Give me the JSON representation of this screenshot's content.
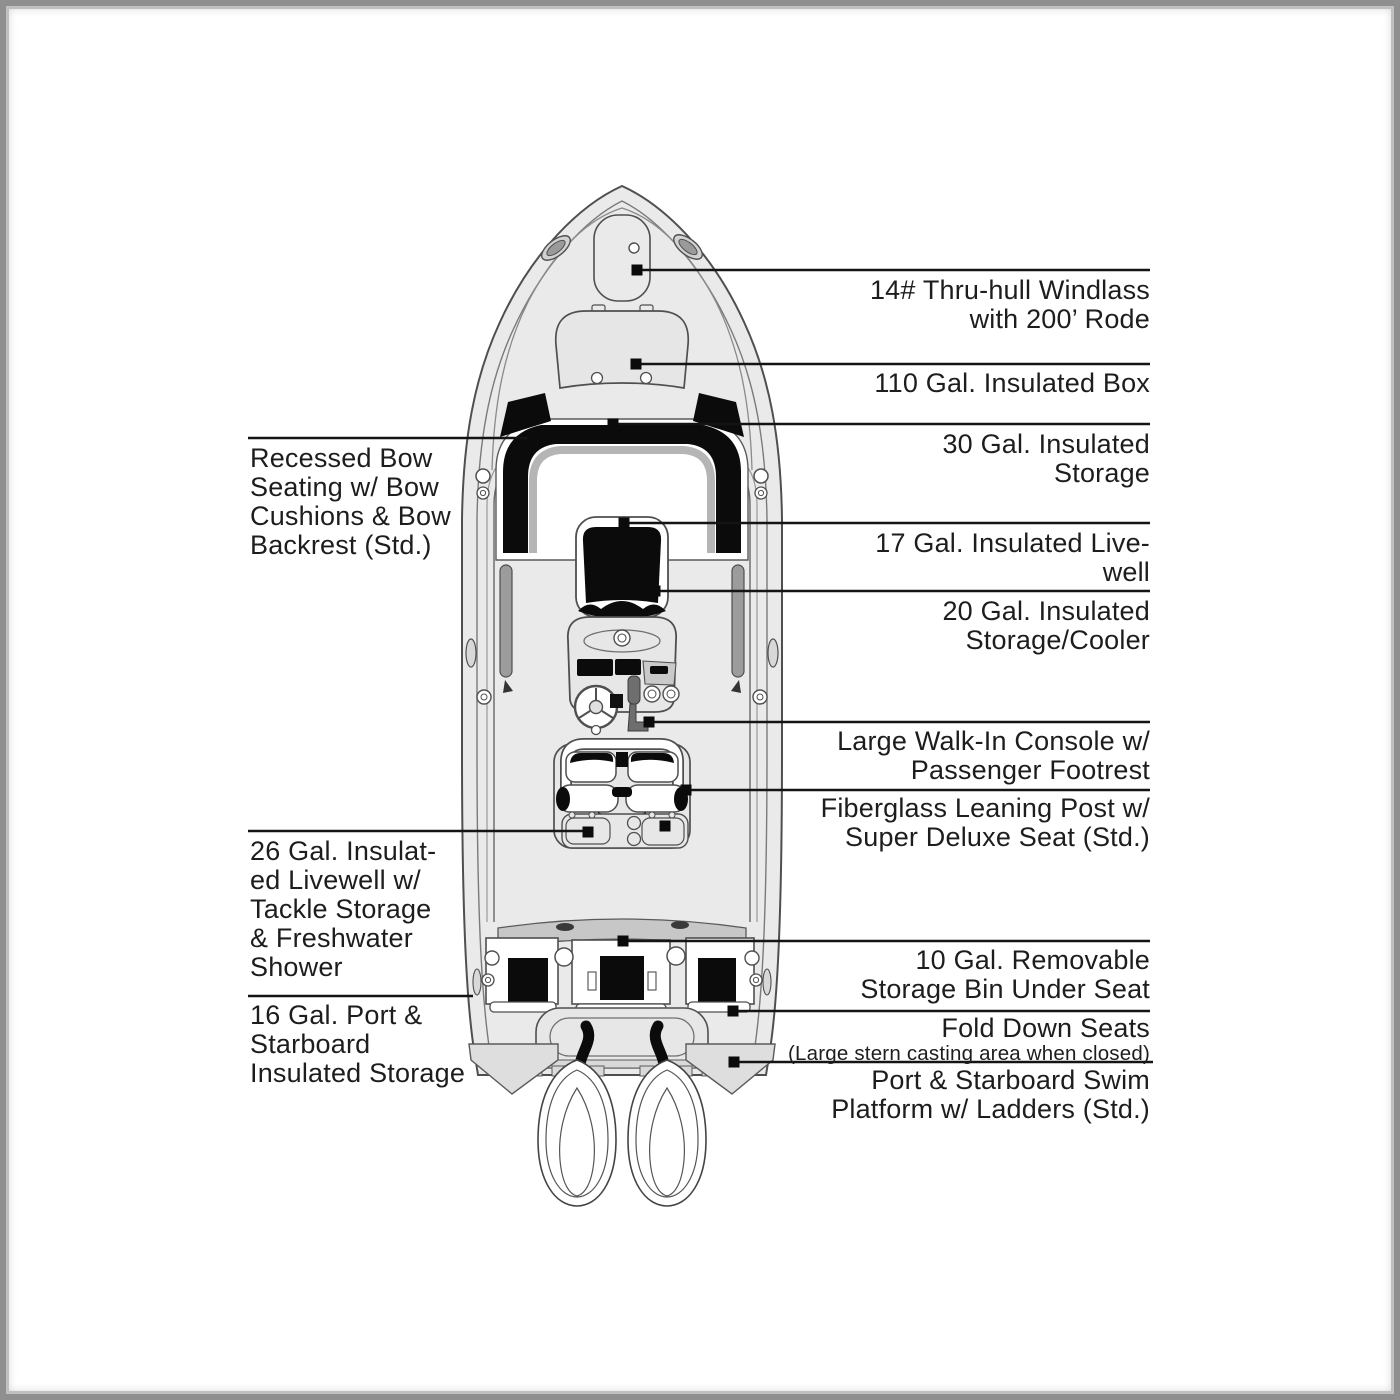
{
  "figure": {
    "kind": "boat deck plan diagram, top view, twin outboard bay boat with callout labels",
    "colors": {
      "background": "#ffffff",
      "frame_border": "#8f8f8f",
      "hull_fill": "#eaeaea",
      "accent_band": "#c7c7c7",
      "cushion_black": "#0b0b0b",
      "line_color": "#141414",
      "text_color": "#1d1d1d"
    }
  },
  "callouts_right": [
    {
      "id": "windlass",
      "lines": [
        "14# Thru-hull Windlass",
        "with 200’ Rode"
      ]
    },
    {
      "id": "insulated-box-110",
      "lines": [
        "110 Gal. Insulated Box"
      ]
    },
    {
      "id": "insulated-storage-30",
      "lines": [
        "30 Gal. Insulated",
        "Storage"
      ]
    },
    {
      "id": "insulated-livewell-17",
      "lines": [
        "17 Gal. Insulated Live-",
        "well"
      ]
    },
    {
      "id": "insulated-storage-cooler-20",
      "lines": [
        "20 Gal. Insulated",
        "Storage/Cooler"
      ]
    },
    {
      "id": "walk-in-console",
      "lines": [
        "Large Walk-In Console w/",
        "Passenger Footrest"
      ]
    },
    {
      "id": "leaning-post",
      "lines": [
        "Fiberglass Leaning Post w/",
        "Super Deluxe Seat (Std.)"
      ]
    },
    {
      "id": "removable-storage-bin-10",
      "lines": [
        "10 Gal. Removable",
        "Storage Bin Under Seat"
      ]
    },
    {
      "id": "fold-down-seats",
      "lines": [
        "Fold Down Seats"
      ],
      "subcaption": "(Large stern casting area when closed)"
    },
    {
      "id": "swim-platform",
      "lines": [
        "Port & Starboard Swim",
        "Platform w/ Ladders (Std.)"
      ]
    }
  ],
  "callouts_left": [
    {
      "id": "recessed-bow-seating",
      "lines": [
        "Recessed Bow",
        "Seating w/ Bow",
        "Cushions & Bow",
        "Backrest (Std.)"
      ]
    },
    {
      "id": "insulated-livewell-26",
      "lines": [
        "26 Gal. Insulat-",
        "ed Livewell w/",
        "Tackle Storage",
        "& Freshwater",
        "Shower"
      ]
    },
    {
      "id": "port-starboard-storage-16",
      "lines": [
        "16 Gal. Port &",
        "Starboard",
        "Insulated Storage"
      ]
    }
  ]
}
